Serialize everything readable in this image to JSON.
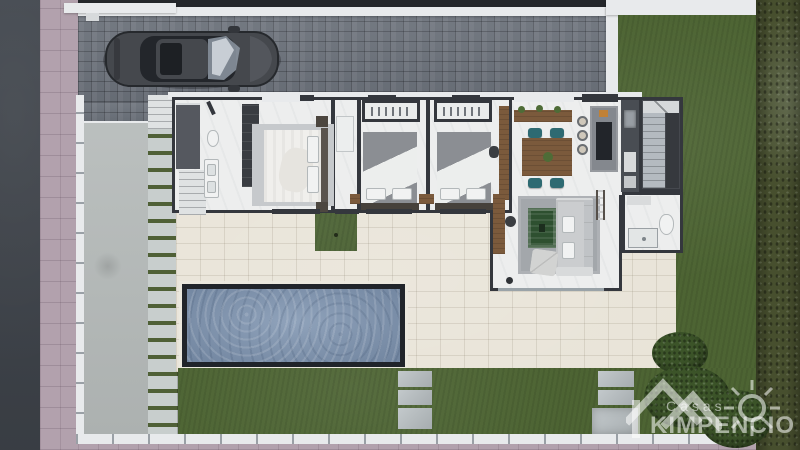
{
  "watermark": {
    "brand_top": "Casas",
    "brand_main": "KIMPENCIO"
  },
  "palette": {
    "road": "#3f444b",
    "sidewalk": "#b2a1ad",
    "driveway": "#6b717a",
    "wall_white": "#e8eaec",
    "concrete": "#b7bcbb",
    "path_paver": "#c8cecd",
    "path_grass": "#4f6036",
    "lawn": "#4d6433",
    "grass_patch": "#4a6132",
    "hedge": "#474f2e",
    "terrace": "#e8e3d7",
    "pool_water": "#8398b3",
    "pool_border": "#20242a",
    "house_floor": "#edeeee",
    "house_wall": "#34373d",
    "wood": "#7b5a3c",
    "chair_teal": "#2e6a72",
    "watermark": "rgba(255,255,255,0.55)"
  }
}
